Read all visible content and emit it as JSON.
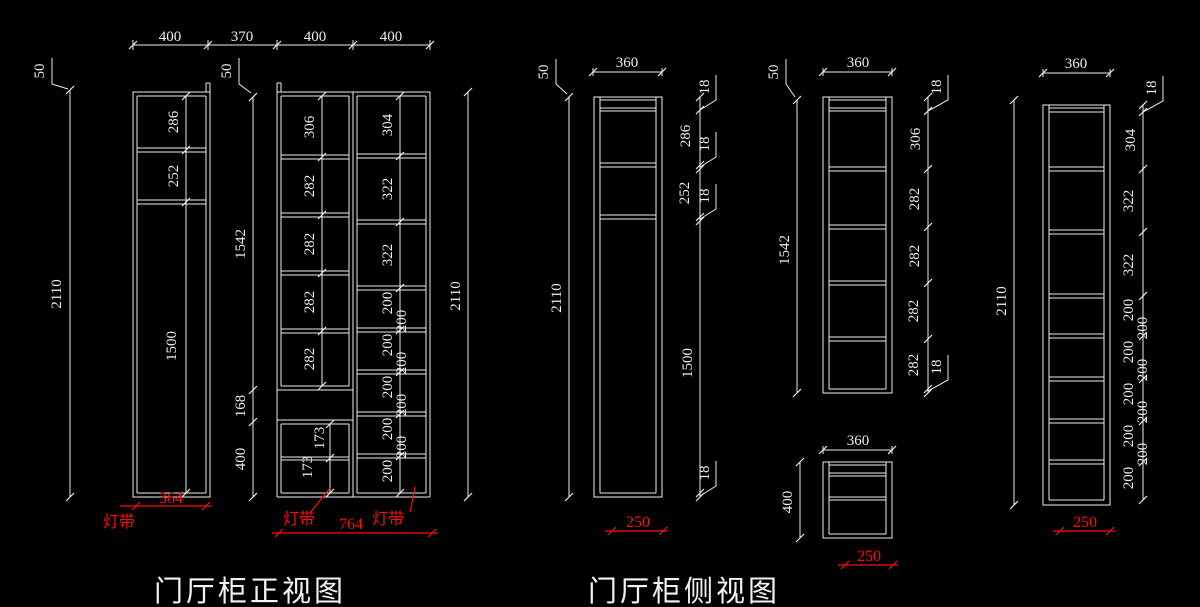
{
  "colors": {
    "background": "#000000",
    "line": "#ededed",
    "dimension_red": "#fb0d0d"
  },
  "front": {
    "title": "门厅柜正视图",
    "top_dims": [
      "400",
      "370",
      "400",
      "400"
    ],
    "cab1": {
      "offset_dim": "50",
      "height_dim": "2110",
      "section_dims": [
        "286",
        "252",
        "1500"
      ],
      "red_width_dim": "364",
      "light_strip_label": "灯带"
    },
    "cab2": {
      "offset_dim": "50",
      "height_dim": "2110",
      "left_chain_dims": [
        "1542",
        "168",
        "400"
      ],
      "left_col_dims": [
        "306",
        "282",
        "282",
        "282",
        "282"
      ],
      "base_dims": [
        "173",
        "173"
      ],
      "right_col_dims": [
        "304",
        "322",
        "322",
        "200",
        "200",
        "200",
        "200",
        "200",
        "200",
        "200",
        "200",
        "200"
      ],
      "red_width_dim": "764",
      "light_strip_label_left": "灯带",
      "light_strip_label_right": "灯带"
    }
  },
  "side": {
    "title": "门厅柜侧视图",
    "view1": {
      "depth_dim": "360",
      "offset_dim": "50",
      "height_dim": "2110",
      "right_chain_dims": [
        "18",
        "286",
        "18",
        "252",
        "18",
        "1500",
        "18"
      ],
      "red_depth_dim": "250"
    },
    "view2": {
      "depth_dim": "360",
      "offset_dim": "50",
      "height_dim": "1542",
      "right_chain_dims": [
        "18",
        "306",
        "282",
        "282",
        "282",
        "282",
        "18"
      ]
    },
    "base_view": {
      "depth_dim": "360",
      "height_dim": "400",
      "red_depth_dim": "250"
    },
    "view3": {
      "depth_dim": "360",
      "height_dim": "2110",
      "right_chain_dims": [
        "18",
        "304",
        "322",
        "322",
        "200",
        "200",
        "200",
        "200",
        "200",
        "200",
        "200",
        "200",
        "200"
      ],
      "red_depth_dim": "250"
    }
  }
}
